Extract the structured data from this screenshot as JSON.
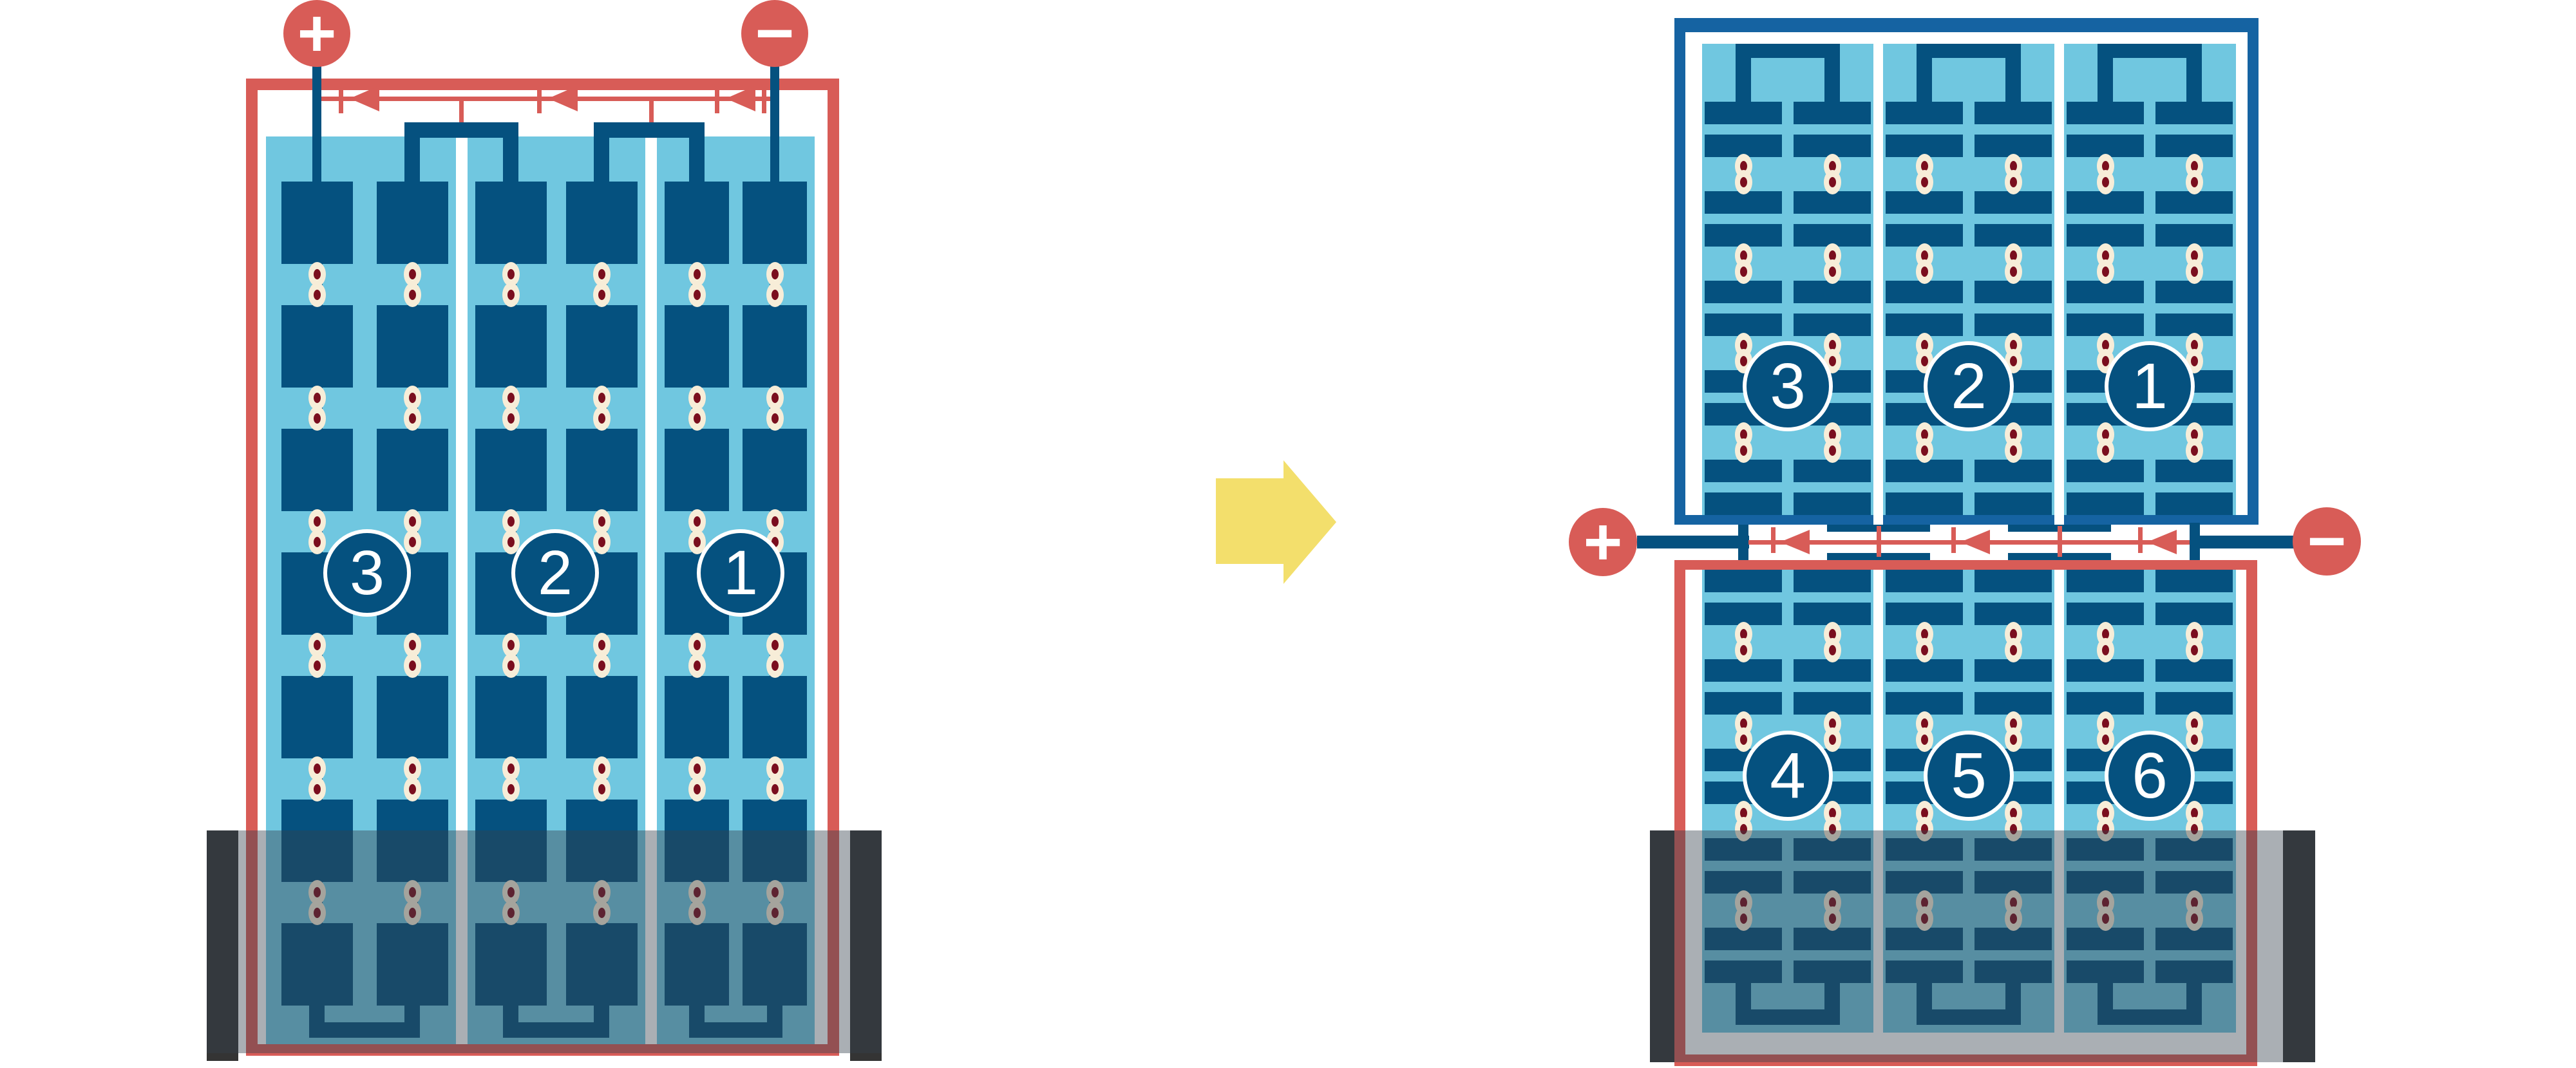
{
  "title": "battery-series-cells-rewiring-diagram",
  "colors": {
    "red": "#D85C57",
    "dark_blue": "#05517F",
    "frame_blue": "#1563A2",
    "light_blue": "#70C7E0",
    "cream": "#F7EDD8",
    "maroon": "#7A0E1E",
    "yellow": "#F3DF6C",
    "cap_gray": "#343434",
    "overlay": "rgba(52,64,76,0.42)"
  },
  "left_battery": {
    "plus": "+",
    "minus": "−",
    "cells": [
      {
        "number": "3"
      },
      {
        "number": "2"
      },
      {
        "number": "1"
      }
    ]
  },
  "right_battery": {
    "plus": "+",
    "minus": "−",
    "top_cells": [
      {
        "number": "3"
      },
      {
        "number": "2"
      },
      {
        "number": "1"
      }
    ],
    "bottom_cells": [
      {
        "number": "4"
      },
      {
        "number": "5"
      },
      {
        "number": "6"
      }
    ]
  },
  "transform_arrow": {
    "direction": "right"
  }
}
